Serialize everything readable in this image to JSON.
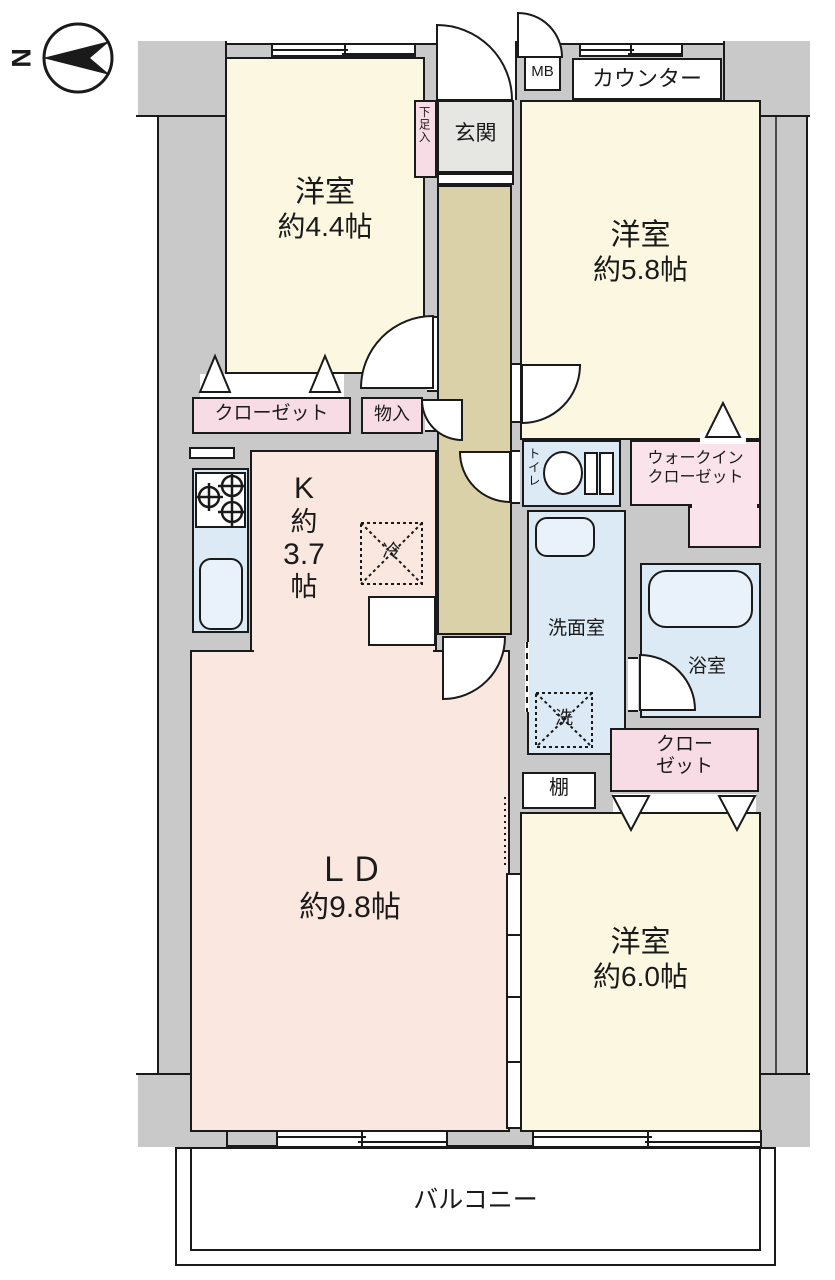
{
  "title": "apartment-floor-plan",
  "compass": {
    "letter": "N"
  },
  "rooms": {
    "western_room_1": {
      "name": "洋室",
      "size": "約4.4帖"
    },
    "western_room_2": {
      "name": "洋室",
      "size": "約5.8帖"
    },
    "western_room_3": {
      "name": "洋室",
      "size": "約6.0帖"
    },
    "living_dining": {
      "name": "ＬＤ",
      "size": "約9.8帖"
    },
    "kitchen": {
      "lines": [
        "K",
        "約",
        "3.7",
        "帖"
      ]
    },
    "entrance": {
      "label": "玄関"
    },
    "shoe_box": {
      "label": "下足入"
    },
    "meter_box": {
      "label": "MB"
    },
    "counter": {
      "label": "カウンター"
    },
    "closet_north": {
      "label": "クローゼット"
    },
    "storage": {
      "label": "物入"
    },
    "toilet": {
      "label": "トイレ"
    },
    "walk_in_closet": {
      "line1": "ウォークイン",
      "line2": "クローゼット"
    },
    "washroom": {
      "label": "洗面室"
    },
    "bathroom": {
      "label": "浴室"
    },
    "washer": {
      "label": "洗"
    },
    "fridge": {
      "label": "冷"
    },
    "closet_south": {
      "line1": "クロー",
      "line2": "ゼット"
    },
    "shelf": {
      "label": "棚"
    },
    "balcony": {
      "label": "バルコニー"
    }
  },
  "colors": {
    "wall": "#c9c9c9",
    "line": "#1a1a1a",
    "cream": "#fcf7e1",
    "peach": "#fae8e0",
    "tan": "#dbd1a8",
    "blue": "#dceaf5",
    "blue2": "#e9f2fa",
    "pink": "#f8dce5",
    "pink2": "#fbe3eb",
    "genkan": "#e6e6e2"
  }
}
